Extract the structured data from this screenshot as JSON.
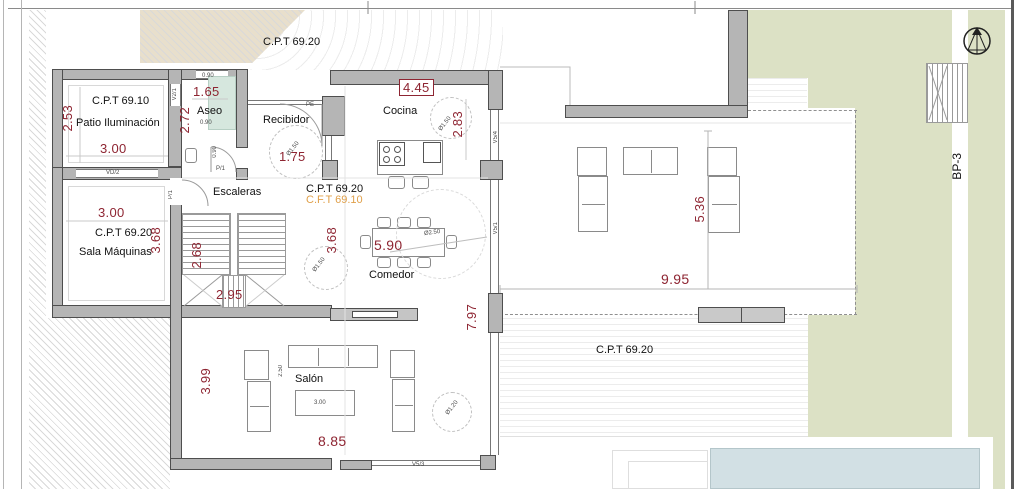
{
  "labels": {
    "cpt_top": "C.P.T 69.20",
    "patio_cpt": "C.P.T 69.10",
    "patio_name": "Patio Iluminación",
    "sala_cpt": "C.P.T 69.20",
    "sala_name": "Sala Máquinas",
    "aseo_name": "Aseo",
    "recibidor_name": "Recibidor",
    "cocina_name": "Cocina",
    "escaleras_name": "Escaleras",
    "comedor_name": "Comedor",
    "salon_name": "Salón",
    "nivel_cpt": "C.P.T 69.20",
    "nivel_cft": "C.F.T 69.10",
    "terraza_cpt": "C.P.T 69.20",
    "bp3": "BP-3"
  },
  "dims": {
    "patio_h": "2.53",
    "patio_w": "3.00",
    "sala_w": "3.00",
    "sala_h": "3.68",
    "aseo_w": "1.65",
    "aseo_h": "2.72",
    "recibidor_w": "1.75",
    "cocina_w": "4.45",
    "cocina_h": "2.83",
    "esc_h": "2.68",
    "esc_w": "2.95",
    "centro_h": "3.68",
    "comedor_w": "5.90",
    "living_h": "7.97",
    "salon_h": "3.99",
    "salon_w": "8.85",
    "sofa_d": "2.50",
    "mesa_w": "3.00",
    "terraza_h": "5.36",
    "terraza_w": "9.95"
  },
  "tags": {
    "pe": "PE",
    "p1_aseo": "P/1",
    "p1_esc": "P/1",
    "vd2": "VD/2",
    "v21": "V2/1",
    "v54": "V5/4",
    "v51": "V5/1",
    "v53": "V5/3",
    "w090_top": "0.90",
    "w090_mid": "0.90",
    "w090_door": "0.90",
    "r150_rec": "Ø1.50",
    "r150_coc": "Ø1.50",
    "r150_com": "Ø1.50",
    "r120_sal": "Ø1.20",
    "r250_com": "Ø2.50"
  },
  "colors": {
    "dimension_text": "#8e2532",
    "cft_text": "#e0a04a",
    "garden_green": "#dce1c5",
    "garden_bed_beige": "#e8dfcc",
    "pool_blue": "#d2e0e4",
    "wall_gray": "#b5b5b5",
    "shower_teal": "#d6e7de"
  }
}
